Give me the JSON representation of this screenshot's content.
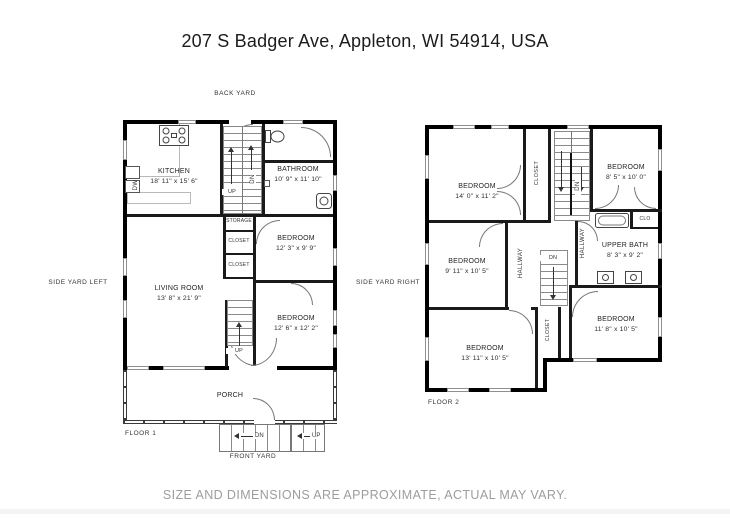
{
  "title": "207 S Badger Ave, Appleton, WI 54914, USA",
  "disclaimer": "SIZE AND DIMENSIONS ARE APPROXIMATE, ACTUAL MAY VARY.",
  "yards": {
    "back": "BACK YARD",
    "left": "SIDE YARD LEFT",
    "right": "SIDE YARD RIGHT",
    "front": "FRONT YARD"
  },
  "floor1": {
    "label": "FLOOR 1",
    "porch": "PORCH",
    "rooms": {
      "kitchen": {
        "name": "KITCHEN",
        "dims": "18' 11\" x 15' 6\""
      },
      "bathroom": {
        "name": "BATHROOM",
        "dims": "10' 9\" x 11' 10\""
      },
      "bedroom1": {
        "name": "BEDROOM",
        "dims": "12' 3\" x 9' 9\""
      },
      "living": {
        "name": "LIVING ROOM",
        "dims": "13' 8\" x 21' 9\""
      },
      "bedroom2": {
        "name": "BEDROOM",
        "dims": "12' 6\" x 12' 2\""
      }
    },
    "labels": {
      "storage": "STORAGE",
      "closet_a": "CLOSET",
      "closet_b": "CLOSET",
      "dw": "DW",
      "stair_top_up": "UP",
      "stair_top_dn": "DN",
      "stair_bottom_up": "UP",
      "steps_dn": "DN",
      "steps_up": "UP"
    }
  },
  "floor2": {
    "label": "FLOOR 2",
    "rooms": {
      "bedroom1": {
        "name": "BEDROOM",
        "dims": "14' 0\" x 11' 2\""
      },
      "bedroom2": {
        "name": "BEDROOM",
        "dims": "8' 5\" x 10' 0\""
      },
      "bedroom3": {
        "name": "BEDROOM",
        "dims": "9' 11\" x 10' 5\""
      },
      "upper_bath": {
        "name": "UPPER BATH",
        "dims": "8' 3\" x 9' 2\""
      },
      "bedroom4": {
        "name": "BEDROOM",
        "dims": "11' 8\" x 10' 5\""
      },
      "bedroom5": {
        "name": "BEDROOM",
        "dims": "13' 11\" x 10' 5\""
      }
    },
    "labels": {
      "hallway_a": "HALLWAY",
      "hallway_b": "HALLWAY",
      "closet_stairs": "CLOSET",
      "closet_bottom": "CLOSET",
      "clo": "CLO",
      "dn_top": "DN",
      "dn_mid": "DN"
    }
  },
  "colors": {
    "wall": "#000000",
    "text": "#222222",
    "muted": "#9d9d9d"
  }
}
